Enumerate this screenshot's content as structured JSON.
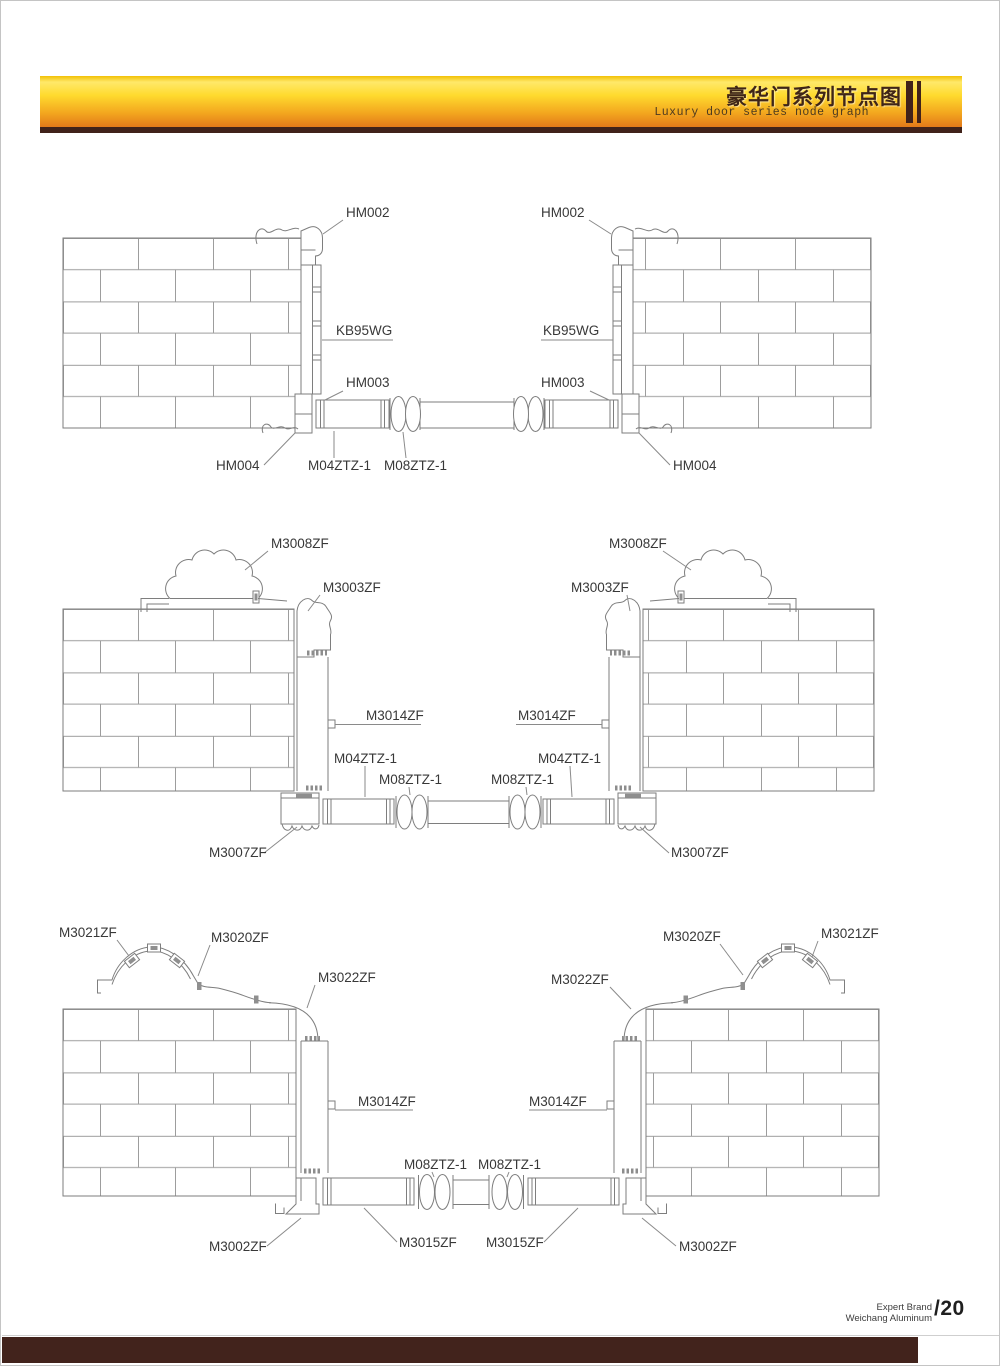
{
  "header": {
    "title_cn": "豪华门系列节点图",
    "subtitle_en": "Luxury door series node graph"
  },
  "footer": {
    "brand_line1": "Expert Brand",
    "brand_line2": "Weichang Aluminum",
    "page_number": "/20"
  },
  "colors": {
    "banner_yellow": "#ffda2e",
    "banner_orange": "#e2791a",
    "dark_brown": "#40221a",
    "line_gray": "#7e7e7e"
  },
  "diagram1": {
    "labels": {
      "hm002_left": "HM002",
      "hm002_right": "HM002",
      "kb95wg_left": "KB95WG",
      "kb95wg_right": "KB95WG",
      "hm003_left": "HM003",
      "hm003_right": "HM003",
      "hm004_left": "HM004",
      "hm004_right": "HM004",
      "m04ztz_left": "M04ZTZ-1",
      "m08ztz_left": "M08ZTZ-1"
    }
  },
  "diagram2": {
    "labels": {
      "m3008zf_left": "M3008ZF",
      "m3008zf_right": "M3008ZF",
      "m3003zf_left": "M3003ZF",
      "m3003zf_right": "M3003ZF",
      "m3014zf_left": "M3014ZF",
      "m3014zf_right": "M3014ZF",
      "m04ztz_left": "M04ZTZ-1",
      "m04ztz_right": "M04ZTZ-1",
      "m08ztz_left": "M08ZTZ-1",
      "m08ztz_right": "M08ZTZ-1",
      "m3007zf_left": "M3007ZF",
      "m3007zf_right": "M3007ZF"
    }
  },
  "diagram3": {
    "labels": {
      "m3021zf_left": "M3021ZF",
      "m3021zf_right": "M3021ZF",
      "m3020zf_left": "M3020ZF",
      "m3020zf_right": "M3020ZF",
      "m3022zf_left": "M3022ZF",
      "m3022zf_right": "M3022ZF",
      "m3014zf_left": "M3014ZF",
      "m3014zf_right": "M3014ZF",
      "m08ztz_left": "M08ZTZ-1",
      "m08ztz_right": "M08ZTZ-1",
      "m3015zf_left": "M3015ZF",
      "m3015zf_right": "M3015ZF",
      "m3002zf_left": "M3002ZF",
      "m3002zf_right": "M3002ZF"
    }
  }
}
